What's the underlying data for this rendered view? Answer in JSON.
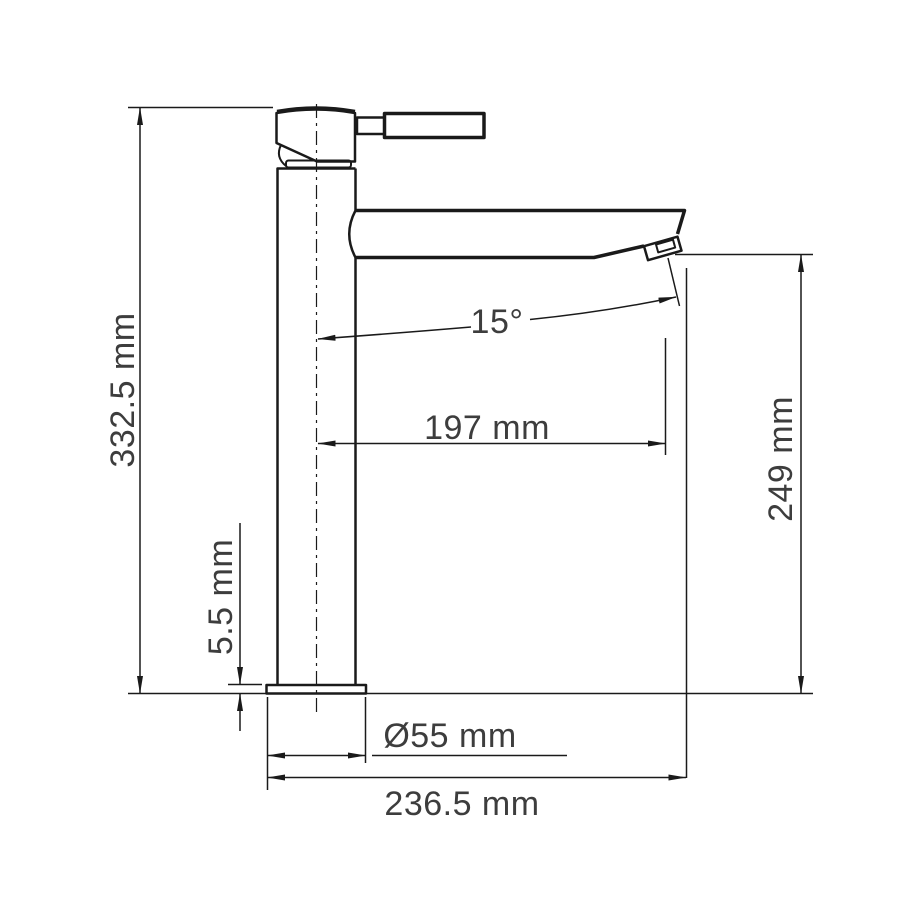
{
  "drawing": {
    "subject": "single-lever tall basin mixer faucet, side elevation with dimensions",
    "background_color": "#ffffff",
    "line_color": "#1a1a1a",
    "text_color": "#3d3d3d",
    "dimensions": {
      "overall_height": "332.5 mm",
      "base_plate_thickness": "5.5 mm",
      "spout_angle": "15°",
      "spout_reach": "197 mm",
      "outlet_height": "249 mm",
      "base_diameter": "Ø55 mm",
      "overall_depth": "236.5 mm"
    }
  }
}
